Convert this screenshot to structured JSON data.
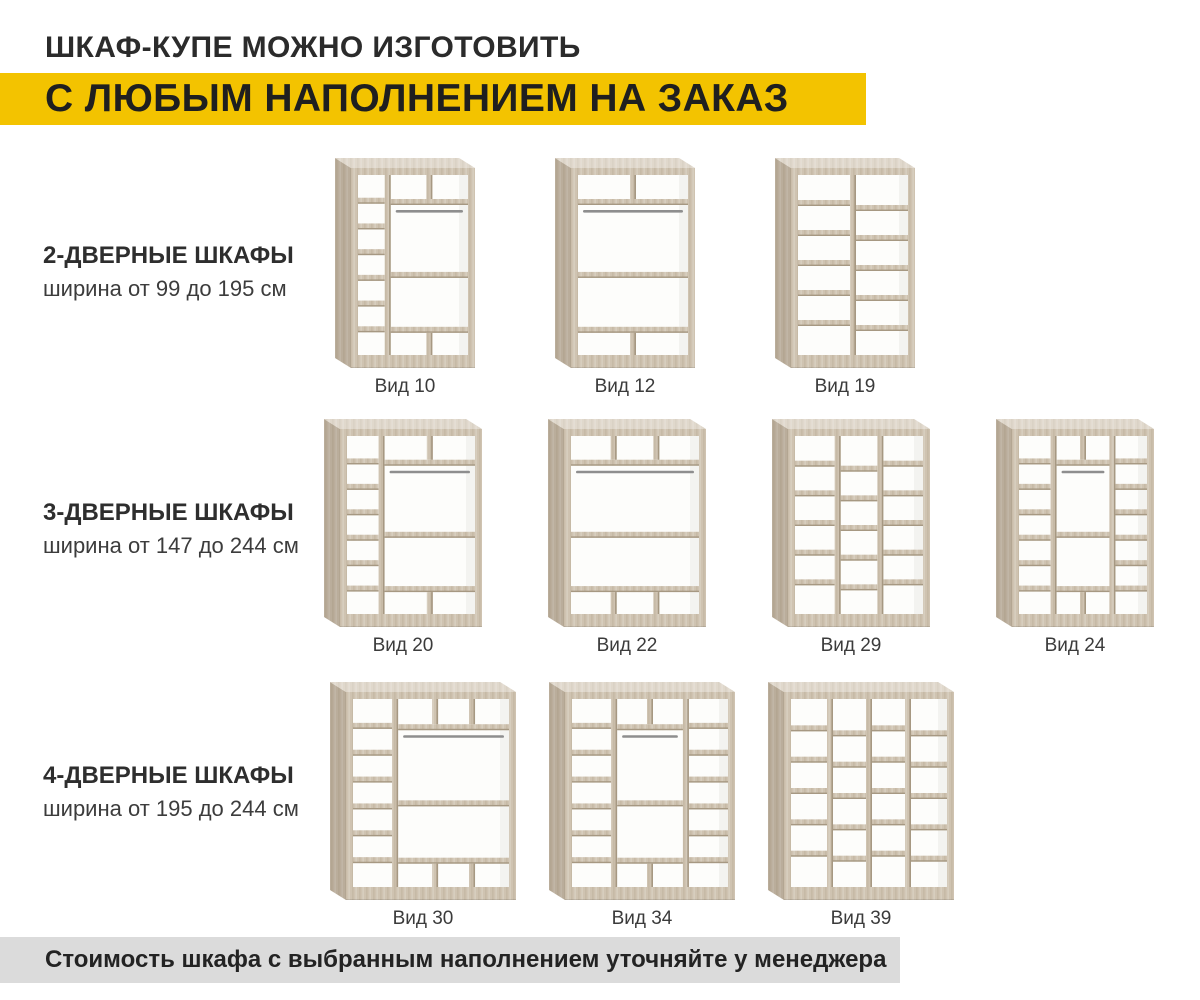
{
  "header": {
    "title_line1": "ШКАФ-КУПЕ МОЖНО ИЗГОТОВИТЬ",
    "title_line2": "С ЛЮБЫМ НАПОЛНЕНИЕМ НА ЗАКАЗ"
  },
  "footer": {
    "note": "Стоимость шкафа с выбранным наполнением уточняйте у менеджера"
  },
  "sections": [
    {
      "title": "2-ДВЕРНЫЕ ШКАФЫ",
      "subtitle": "ширина от 99 до 195 см",
      "items": [
        {
          "label": "Вид 10",
          "layout": {
            "kind": "hang",
            "leftCol": true,
            "rightCol": false,
            "topDividers": 1,
            "bottomDividers": 1
          }
        },
        {
          "label": "Вид 12",
          "layout": {
            "kind": "hang",
            "leftCol": false,
            "rightCol": false,
            "topDividers": 1,
            "bottomDividers": 1
          }
        },
        {
          "label": "Вид 19",
          "layout": {
            "kind": "grid",
            "cols": 2,
            "rows": 6
          }
        }
      ]
    },
    {
      "title": "3-ДВЕРНЫЕ ШКАФЫ",
      "subtitle": "ширина от 147 до 244 см",
      "items": [
        {
          "label": "Вид 20",
          "layout": {
            "kind": "hang",
            "leftCol": true,
            "rightCol": false,
            "topDividers": 1,
            "bottomDividers": 1
          }
        },
        {
          "label": "Вид 22",
          "layout": {
            "kind": "hang",
            "leftCol": false,
            "rightCol": false,
            "topDividers": 2,
            "bottomDividers": 2
          }
        },
        {
          "label": "Вид 29",
          "layout": {
            "kind": "grid",
            "cols": 3,
            "rows": 6
          }
        },
        {
          "label": "Вид 24",
          "layout": {
            "kind": "hang",
            "leftCol": true,
            "rightCol": true,
            "topDividers": 1,
            "bottomDividers": 1
          }
        }
      ]
    },
    {
      "title": "4-ДВЕРНЫЕ ШКАФЫ",
      "subtitle": "ширина от 195 до 244 см",
      "items": [
        {
          "label": "Вид 30",
          "layout": {
            "kind": "hang",
            "leftCol": true,
            "rightCol": false,
            "topDividers": 2,
            "bottomDividers": 2
          }
        },
        {
          "label": "Вид 34",
          "layout": {
            "kind": "hang",
            "leftCol": true,
            "rightCol": true,
            "topDividers": 1,
            "bottomDividers": 1
          }
        },
        {
          "label": "Вид 39",
          "layout": {
            "kind": "grid",
            "cols": 4,
            "rows": 6
          }
        }
      ]
    }
  ],
  "colors": {
    "accent_yellow": "#f3c300",
    "footer_gray": "#dbdbdb",
    "heading_text": "#2b2b2b",
    "wood": "#cfc3b1",
    "wood_edge": "#a69882",
    "rod_gray": "#8e8e8e",
    "interior_white": "#fdfdfb"
  }
}
